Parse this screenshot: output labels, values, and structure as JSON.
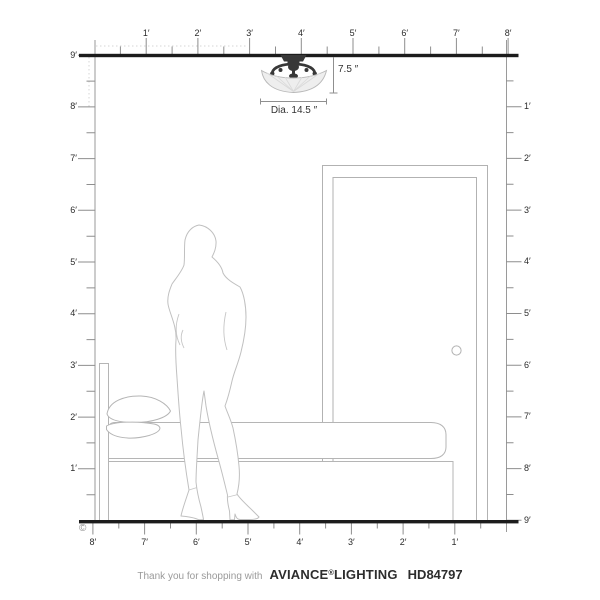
{
  "diagram": {
    "fixture": {
      "height_label": "7.5 ″",
      "diameter_label": "Dia. 14.5 ″"
    },
    "rulers": {
      "top": {
        "labels": [
          "1′",
          "2′",
          "3′",
          "4′",
          "5′",
          "6′",
          "7′",
          "8′"
        ]
      },
      "bottom": {
        "labels": [
          "8′",
          "7′",
          "6′",
          "5′",
          "4′",
          "3′",
          "2′",
          "1′"
        ]
      },
      "left": {
        "labels": [
          "9′",
          "8′",
          "7′",
          "6′",
          "5′",
          "4′",
          "3′",
          "2′",
          "1′"
        ]
      },
      "right": {
        "labels": [
          "1′",
          "2′",
          "3′",
          "4′",
          "5′",
          "6′",
          "7′",
          "8′",
          "9′"
        ]
      }
    },
    "copyright_symbol": "©"
  },
  "footer": {
    "message": "Thank you for shopping with",
    "brand_name": "AVIANCE",
    "registered_mark": "®",
    "brand_suffix": "LIGHTING",
    "model_number": "HD84797"
  },
  "colors": {
    "structure_line": "#1c1c1c",
    "ruler_gray": "#8e8e8e",
    "label_dark": "#2b2b2b",
    "furniture_outline": "#b2b2b2",
    "silhouette_outline": "#c0c0c0",
    "glass_shade": "#ebebeb",
    "metal_dark": "#383838",
    "footer_text_gray": "#9a9a9a",
    "footer_brand_dark": "#2d2d2d"
  }
}
